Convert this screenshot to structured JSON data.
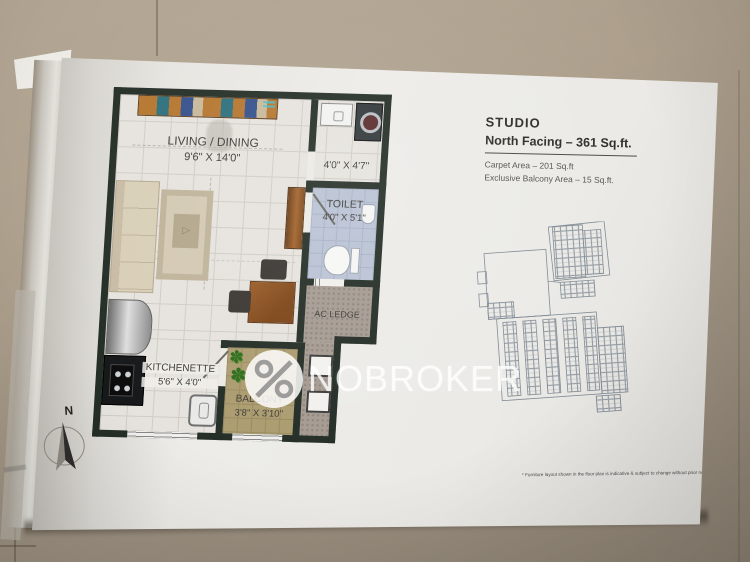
{
  "page": {
    "info": {
      "title": "STUDIO",
      "subtitle": "North Facing – 361 Sq.ft.",
      "carpet_line": "Carpet Area – 201 Sq.ft",
      "balcony_line": "Exclusive Balcony Area – 15 Sq.ft."
    },
    "plan": {
      "living": {
        "name": "LIVING / DINING",
        "dims": "9'6\" X 14'0\""
      },
      "utility": {
        "dims": "4'0\" X 4'7\""
      },
      "toilet": {
        "name": "TOILET",
        "dims": "4'0\" X 5'1\""
      },
      "ac_ledge": {
        "name": "AC LEDGE"
      },
      "kitchenette": {
        "name": "KITCHENETTE",
        "dims": "5'6\" X 4'0\""
      },
      "balcony": {
        "name": "BALCONY",
        "dims": "3'8\" X 3'10\""
      },
      "rug_motif": "▷"
    },
    "watermark": {
      "brand": "NOBROKER",
      "logo": "percent-icon"
    },
    "compass": {
      "label": "N"
    },
    "disclaimer": "* Furniture layout shown in the floor plan is indicative & subject to change without prior notice"
  },
  "colors": {
    "wall": "#242e26",
    "toilet_floor": "#b9c2d4",
    "balcony_floor": "#ac9c70",
    "ac_ledge_floor": "#a59b92",
    "wood": "#a2622a",
    "page": "#eae9e4",
    "floor_background": "#a89b89",
    "watermark_white": "rgba(255,255,255,0.78)"
  }
}
